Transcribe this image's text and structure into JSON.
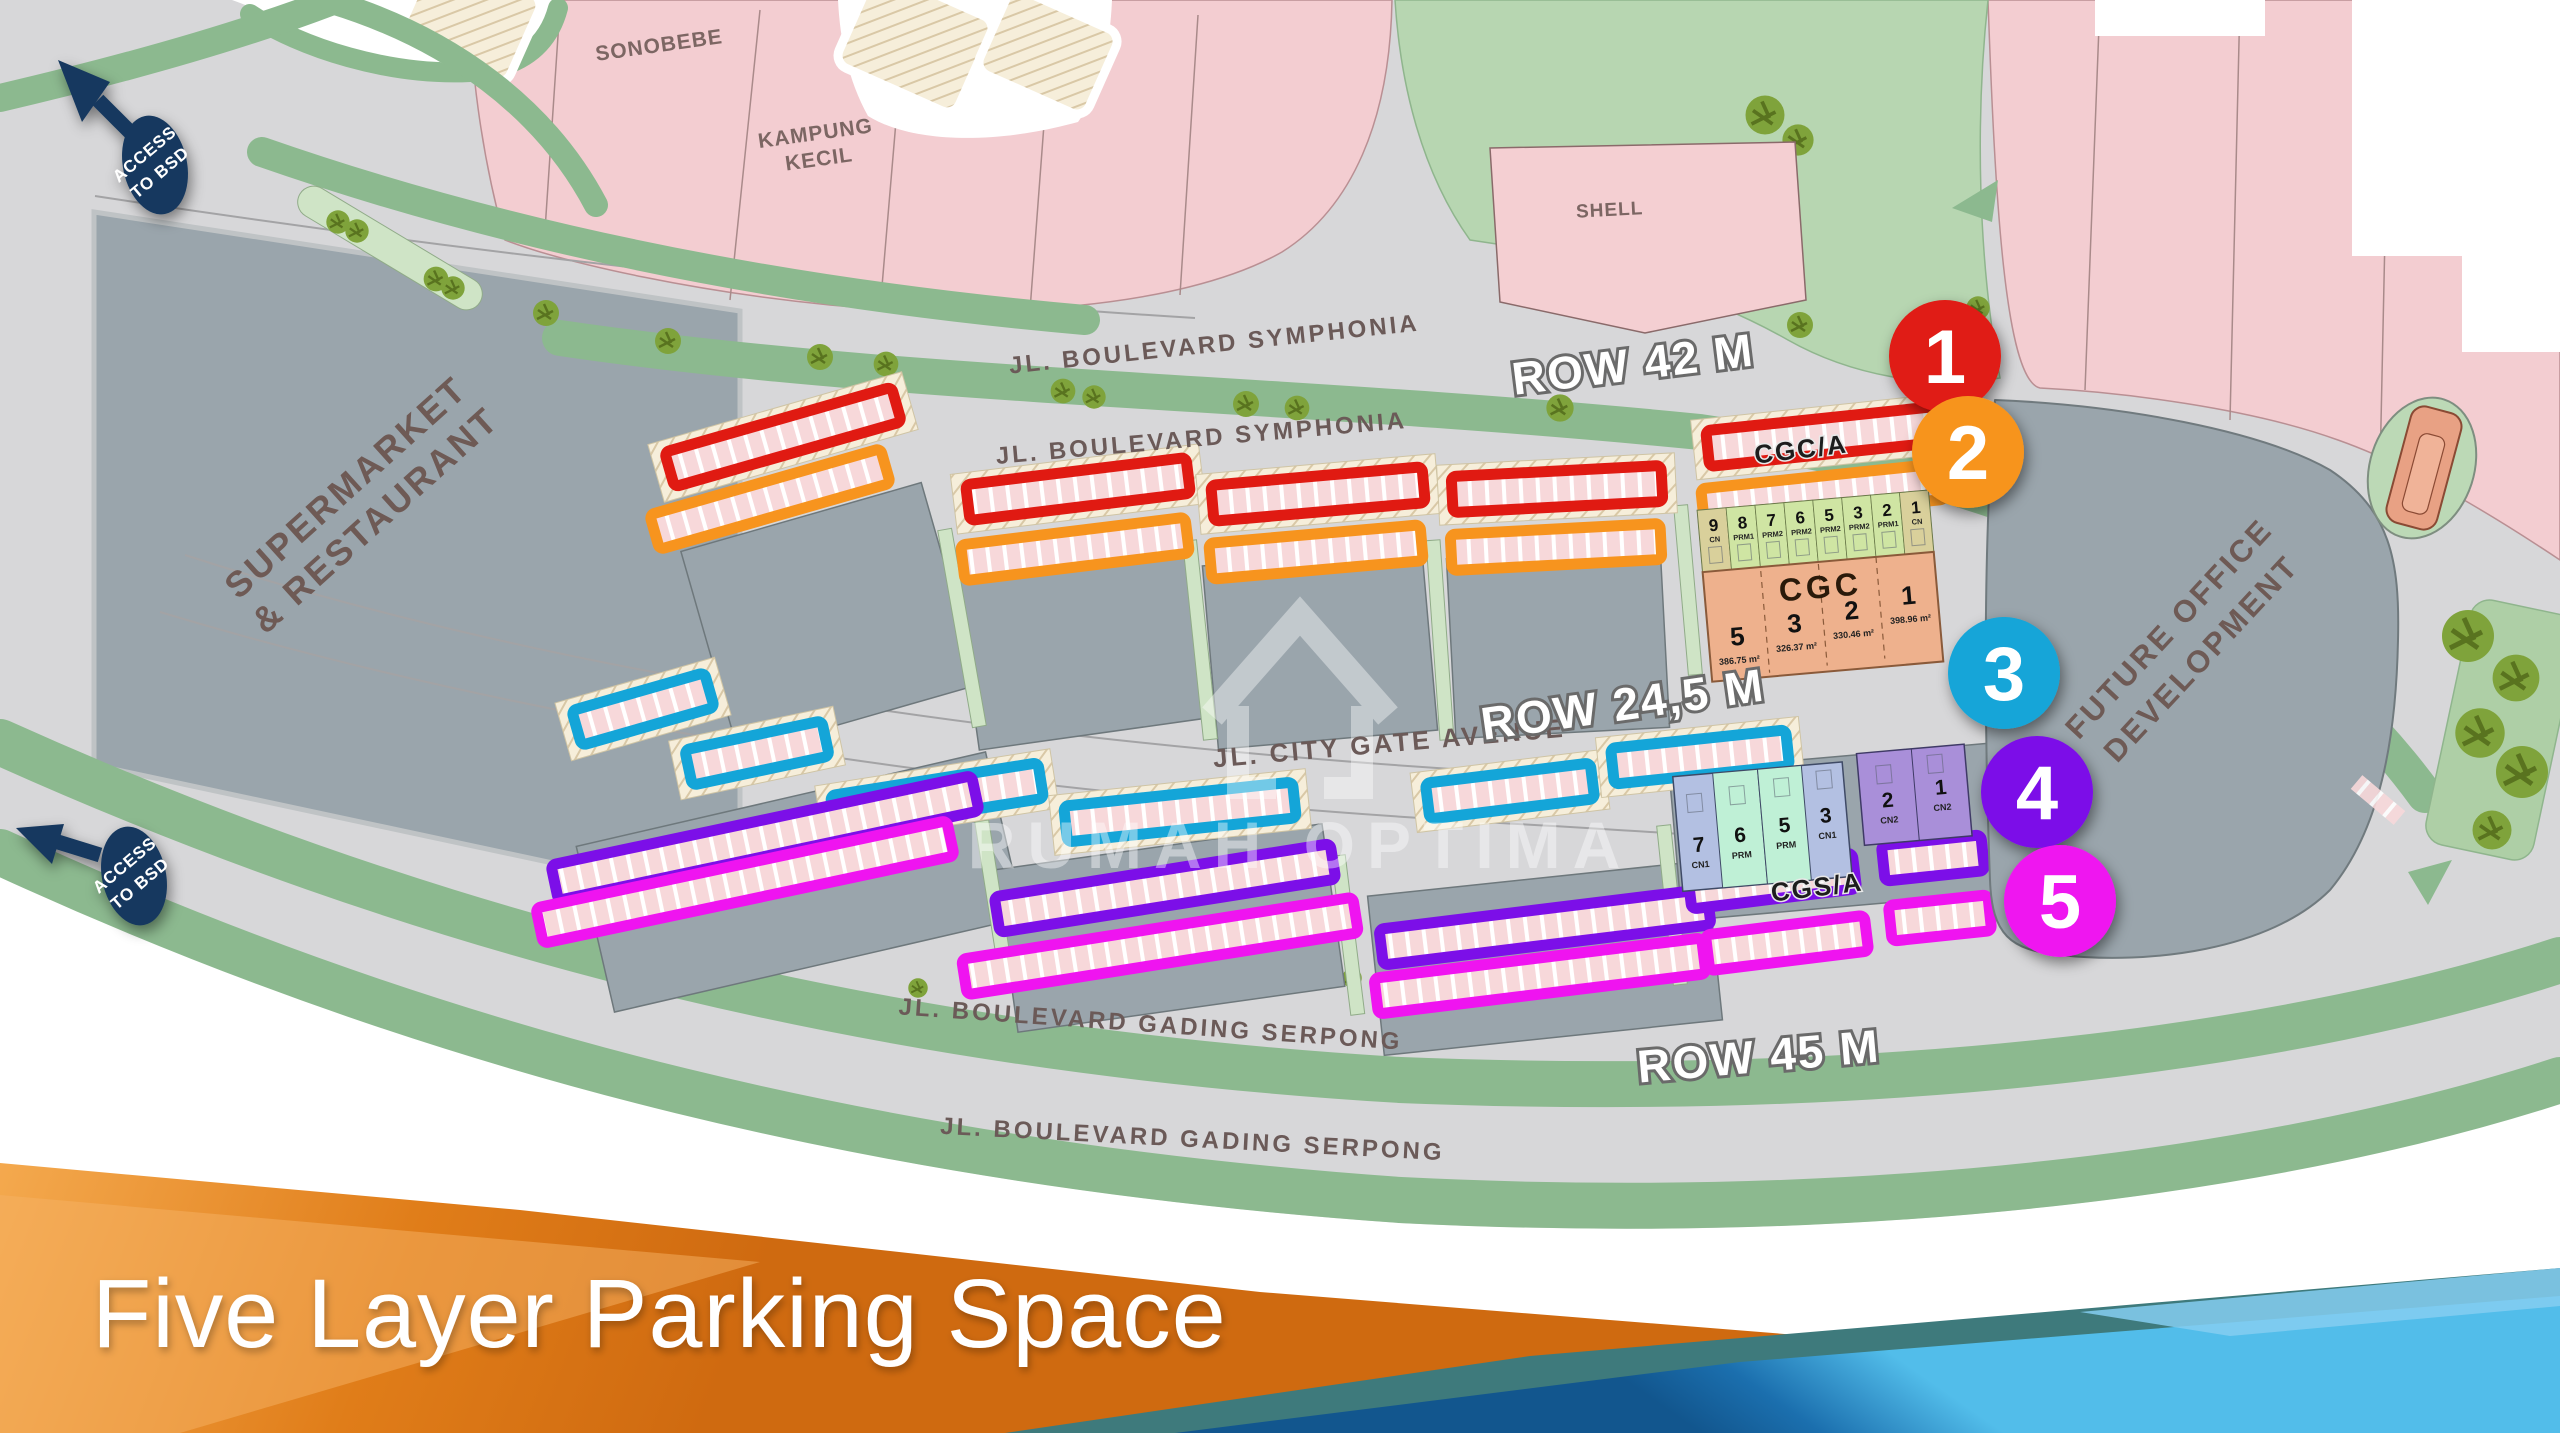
{
  "slide": {
    "title": "Five Layer Parking Space",
    "watermark": "RUMAH OPTIMA"
  },
  "colors": {
    "layer1_red": "#e01a12",
    "layer2_orange": "#f7941e",
    "layer3_cyan": "#14a5d8",
    "layer4_purple": "#7c0fe8",
    "layer5_magenta": "#ef14f0",
    "access_navy": "#17395e",
    "footer_orange": "#e07d19",
    "footer_blue": "#1b6fae"
  },
  "map": {
    "streets": {
      "symphonia_upper": "JL. BOULEVARD SYMPHONIA",
      "symphonia_lower": "JL. BOULEVARD SYMPHONIA",
      "row42": "ROW 42 M",
      "city_gate": "JL. CITY GATE AVENUE",
      "row245": "ROW 24,5 M",
      "gading_serpong_upper": "JL. BOULEVARD GADING SERPONG",
      "row45": "ROW 45 M",
      "gading_serpong_lower": "JL. BOULEVARD GADING SERPONG"
    },
    "places": {
      "sonobebe": "SONOBEBE",
      "kampung_1": "KAMPUNG",
      "kampung_2": "KECIL",
      "shell": "SHELL",
      "supermarket_1": "SUPERMARKET",
      "supermarket_2": "& RESTAURANT",
      "future_office_1": "FUTURE OFFICE",
      "future_office_2": "DEVELOPMENT",
      "cgc_a": "CGC/A",
      "cgs_a": "CGS/A",
      "cgc": "CGC"
    },
    "access": {
      "line1": "ACCESS",
      "line2": "TO BSD"
    },
    "layers": [
      {
        "num": "1",
        "color": "#e01a12"
      },
      {
        "num": "2",
        "color": "#f7941e"
      },
      {
        "num": "3",
        "color": "#14a5d8"
      },
      {
        "num": "4",
        "color": "#7c0fe8"
      },
      {
        "num": "5",
        "color": "#ef14f0"
      }
    ],
    "cgc_upper_units": [
      {
        "num": "9",
        "type": "CN"
      },
      {
        "num": "8",
        "type": "PRM1"
      },
      {
        "num": "7",
        "type": "PRM2"
      },
      {
        "num": "6",
        "type": "PRM2"
      },
      {
        "num": "5",
        "type": "PRM2"
      },
      {
        "num": "3",
        "type": "PRM2"
      },
      {
        "num": "2",
        "type": "PRM1"
      },
      {
        "num": "1",
        "type": "CN"
      }
    ],
    "cgc_lower_units": [
      {
        "num": "5",
        "area": "386.75 m²"
      },
      {
        "num": "3",
        "area": "326.37 m²"
      },
      {
        "num": "2",
        "area": "330.46 m²"
      },
      {
        "num": "1",
        "area": "398.96 m²"
      }
    ],
    "cgs_units": [
      {
        "num": "7",
        "type": "CN1"
      },
      {
        "num": "6",
        "type": "PRM"
      },
      {
        "num": "5",
        "type": "PRM"
      },
      {
        "num": "3",
        "type": "CN1"
      },
      {
        "num": "2",
        "type": "CN2"
      },
      {
        "num": "1",
        "type": "CN2"
      }
    ]
  }
}
